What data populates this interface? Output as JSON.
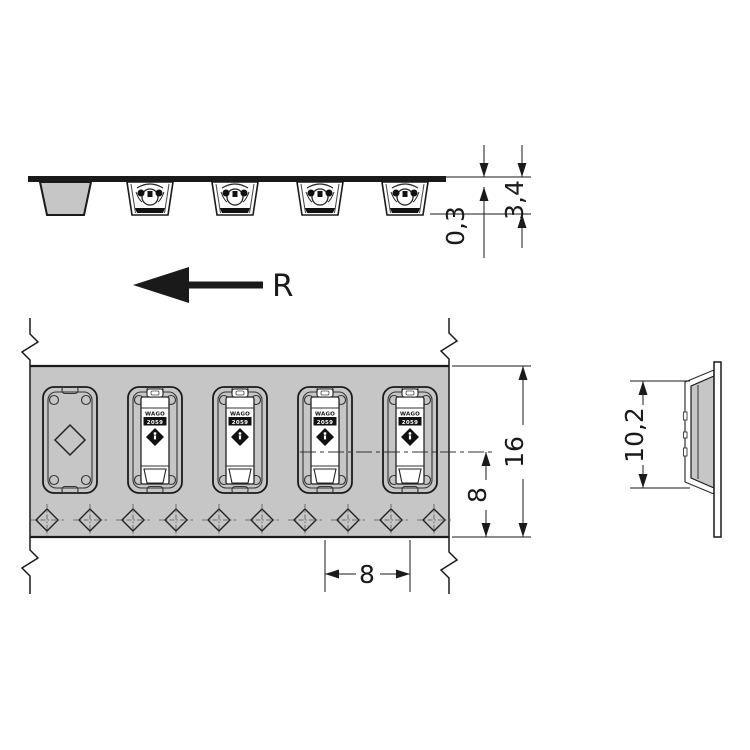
{
  "document": {
    "type": "technical-drawing",
    "views": {
      "side_view": {
        "dims": {
          "tape_thickness": "0,3",
          "pocket_depth": "3,4"
        }
      },
      "feed": {
        "label": "R"
      },
      "plan_view": {
        "dims": {
          "center_to_edge": "8",
          "tape_width": "16",
          "pocket_pitch": "8"
        },
        "component": {
          "brand": "WAGO",
          "series": "2059"
        }
      },
      "profile_view": {
        "dims": {
          "component_height": "10,2"
        }
      }
    },
    "colors": {
      "tape": "#c6c6c6",
      "line": "#1a1a1a",
      "body": "#ffffff",
      "background": "#ffffff"
    }
  }
}
